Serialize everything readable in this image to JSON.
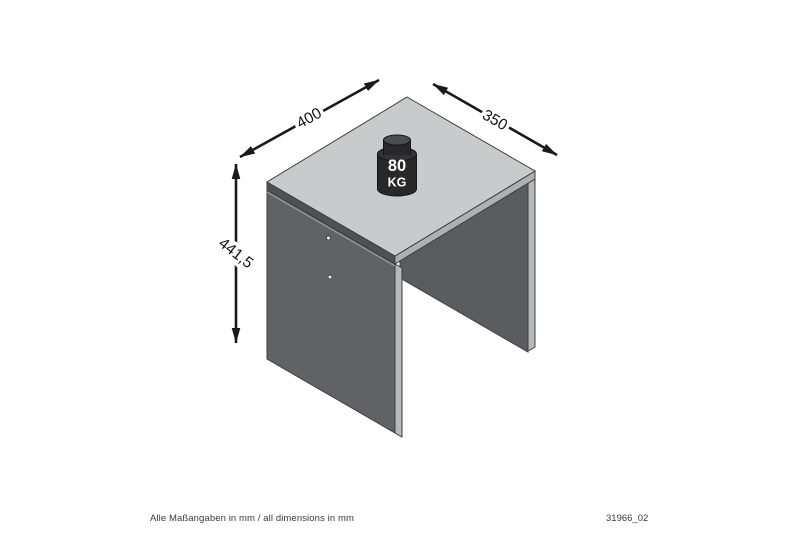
{
  "drawing": {
    "dimensions": {
      "width_mm": "400",
      "depth_mm": "350",
      "height_mm": "441,5"
    },
    "load": {
      "value": "80",
      "unit": "KG"
    },
    "colors": {
      "tabletop_surface": "#c8cacc",
      "left_panel": "#606266",
      "right_panel_inner": "#5a5c60",
      "edge_strip_light": "#b6b8ba",
      "top_edge_dark": "#4f5155",
      "outline": "#3c3e42",
      "weight_body": "#28282a",
      "dimension_ink": "#1a1a1a"
    }
  },
  "footer": {
    "note": "Alle Maßangaben in mm / all dimensions in mm",
    "doc_number": "31966_02"
  }
}
